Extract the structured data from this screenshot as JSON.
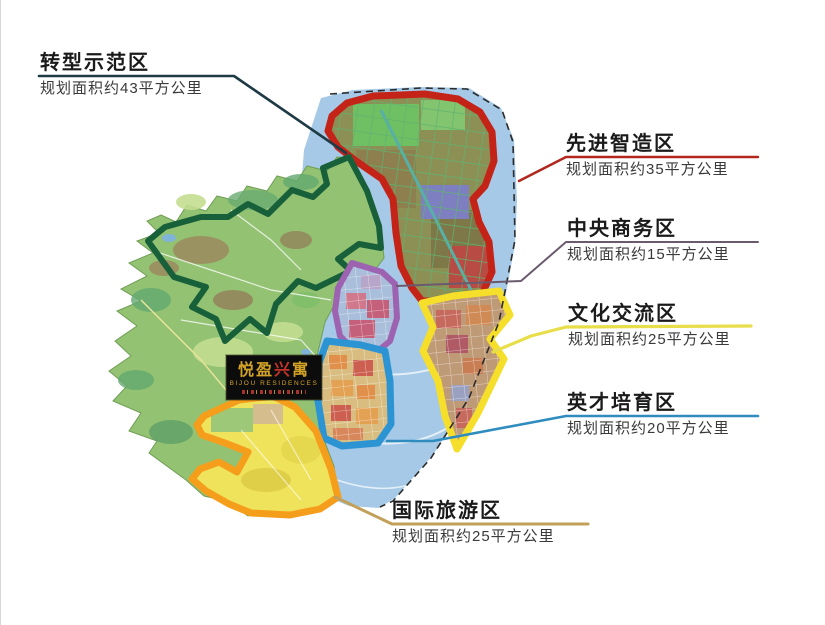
{
  "logo": {
    "chinese_left": "悦盈",
    "chinese_red": "兴",
    "chinese_right": "寓",
    "english": "BIJOU RESIDENCES"
  },
  "zones": [
    {
      "name": "转型示范区",
      "area": "规划面积约43平方公里",
      "outline_color": "#17603a",
      "leader_color": "#1d3a45"
    },
    {
      "name": "先进智造区",
      "area": "规划面积约35平方公里",
      "outline_color": "#c42318",
      "leader_color": "#b2261c"
    },
    {
      "name": "中央商务区",
      "area": "规划面积约15平方公里",
      "outline_color": "#9d62b0",
      "leader_color": "#6b5a6e"
    },
    {
      "name": "文化交流区",
      "area": "规划面积约25平方公里",
      "outline_color": "#f6df2a",
      "leader_color": "#e8de4a"
    },
    {
      "name": "英才培育区",
      "area": "规划面积约20平方公里",
      "outline_color": "#2d94d3",
      "leader_color": "#2f8cbf"
    },
    {
      "name": "国际旅游区",
      "area": "规划面积约25平方公里",
      "outline_color": "#f59e1c",
      "leader_color": "#c2a05a"
    }
  ],
  "map_colors": {
    "water": "#a5c9e6",
    "land": "#93c273",
    "boundary_dash": "#2b2b2b"
  }
}
